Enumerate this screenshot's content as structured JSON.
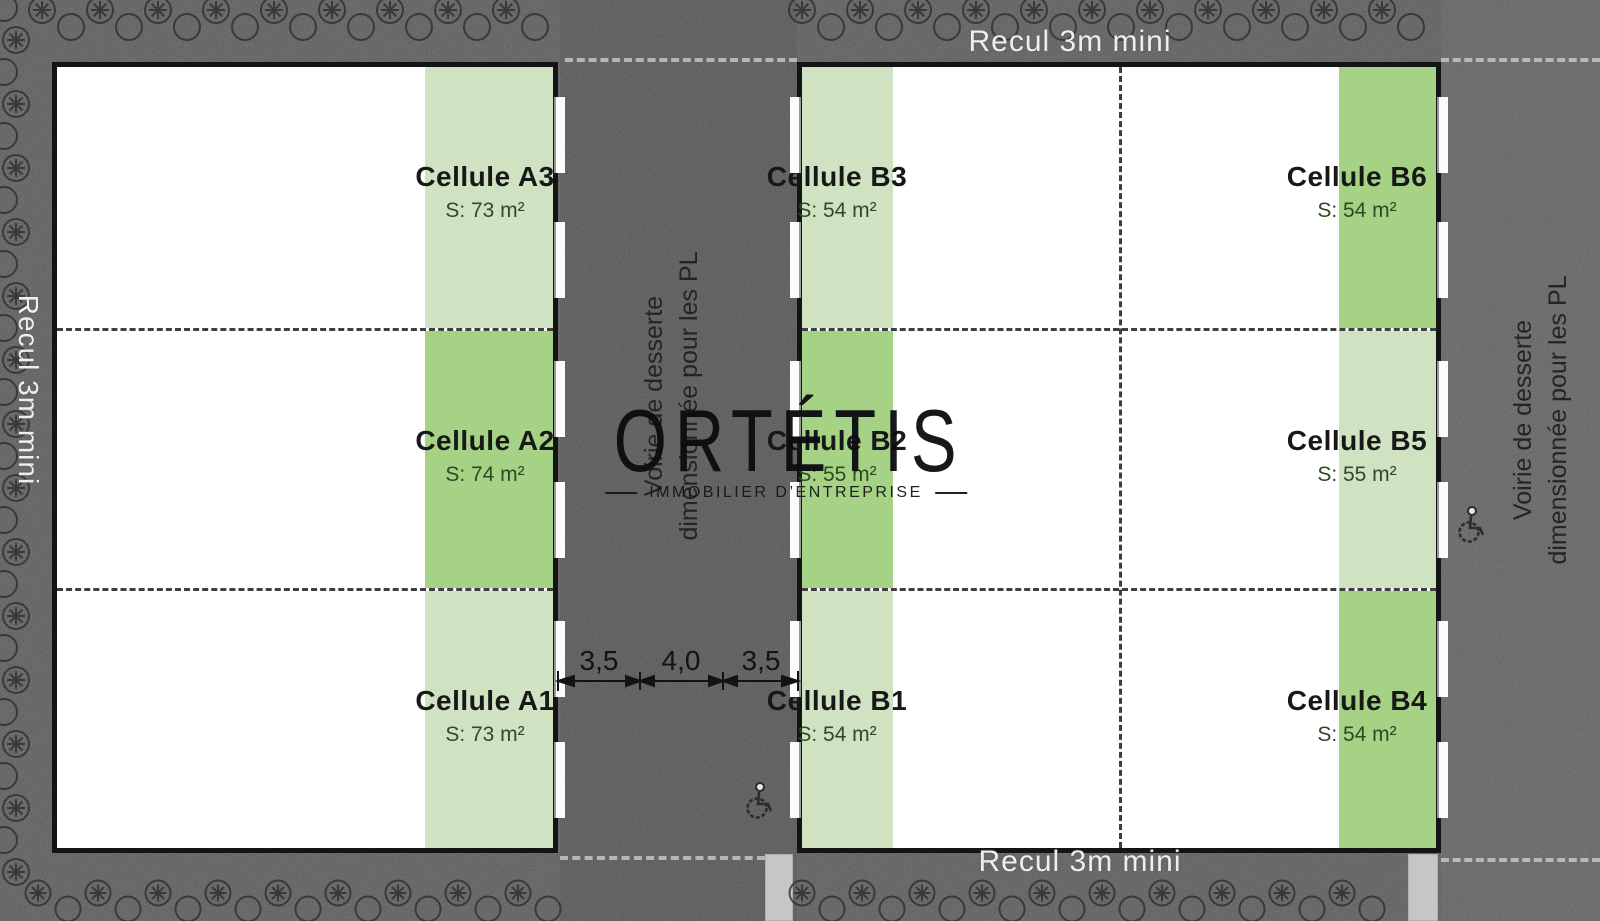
{
  "watermark": {
    "brand": "ORTÉTIS",
    "tagline": "IMMOBILIER D’ENTREPRISE"
  },
  "roads": {
    "recul_top": "Recul 3m mini",
    "recul_bottom": "Recul 3m mini",
    "recul_left": "Recul 3m mini",
    "voirie": {
      "line1": "Voirie de desserte",
      "line2": "dimensionnée pour les PL"
    }
  },
  "dimensions": {
    "values": [
      "3,5",
      "4,0",
      "3,5"
    ]
  },
  "buildings": {
    "a": {
      "cells": [
        {
          "name": "Cellule A3",
          "area": "S: 73 m²",
          "tone": "light"
        },
        {
          "name": "Cellule A2",
          "area": "S: 74 m²",
          "tone": "medium"
        },
        {
          "name": "Cellule A1",
          "area": "S: 73 m²",
          "tone": "light"
        }
      ]
    },
    "b_left": {
      "cells": [
        {
          "name": "Cellule B3",
          "area": "S: 54 m²",
          "tone": "light"
        },
        {
          "name": "Cellule B2",
          "area": "S: 55 m²",
          "tone": "medium"
        },
        {
          "name": "Cellule B1",
          "area": "S: 54 m²",
          "tone": "light"
        }
      ]
    },
    "b_right": {
      "cells": [
        {
          "name": "Cellule B6",
          "area": "S: 54 m²",
          "tone": "medium"
        },
        {
          "name": "Cellule B5",
          "area": "S: 55 m²",
          "tone": "light"
        },
        {
          "name": "Cellule B4",
          "area": "S: 54 m²",
          "tone": "medium"
        }
      ]
    }
  },
  "colors": {
    "road_gray": "#8f8f8f",
    "light_green": "#cfe3c2",
    "medium_green": "#a6d286",
    "outline_black": "#141414",
    "recul_text": "#eeeeee",
    "label_text": "#181818",
    "area_text": "#2d4a22"
  },
  "icons": {
    "wheelchair": "wheelchair-icon",
    "tree": "tree-icon"
  }
}
